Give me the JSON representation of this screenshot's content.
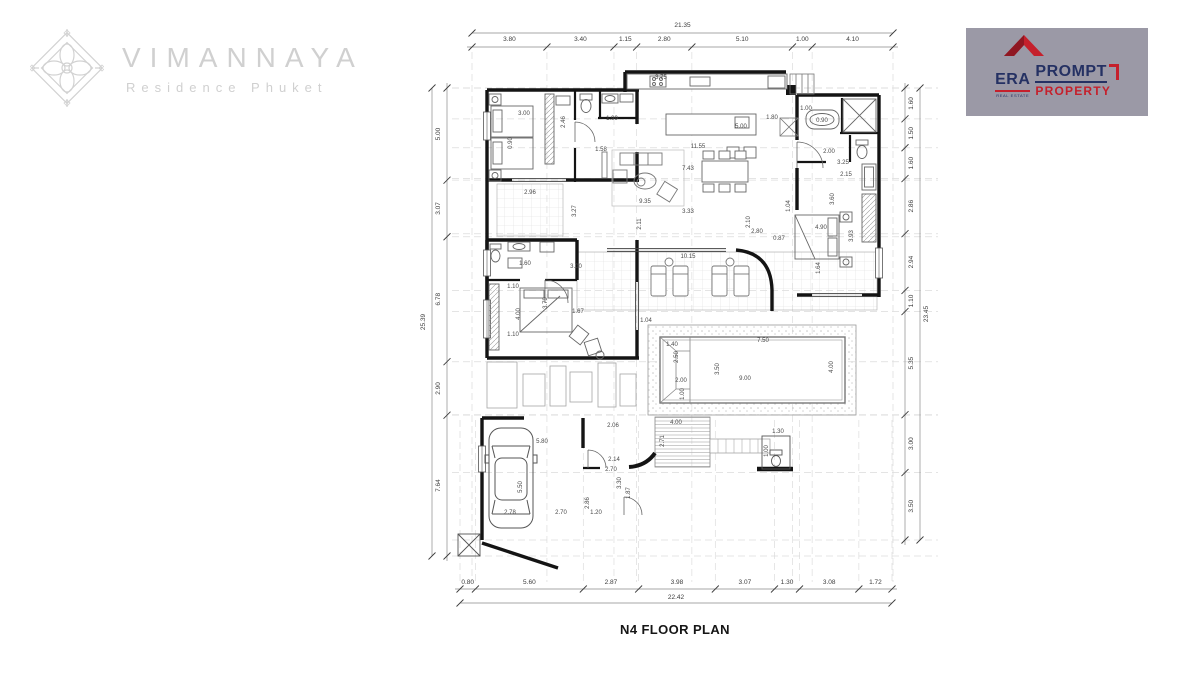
{
  "brand": {
    "name": "VIMANNAYA",
    "subtitle": "Residence Phuket"
  },
  "agency": {
    "era": "ERA",
    "real_estate": "REAL ESTATE",
    "prompt": "PROMPT",
    "property": "PROPERTY"
  },
  "plan_title": "N4 FLOOR PLAN",
  "icons": {
    "brand_ornament": "diamond-mandala",
    "agency_house": "red-roof-house"
  },
  "colors": {
    "brand_gray": "#d0d0d0",
    "agency_bg": "#9b99a6",
    "agency_red": "#c5202c",
    "agency_navy": "#253163",
    "wall": "#141414",
    "thin_line": "#6a6a6a",
    "dim_text": "#3c3c3c",
    "grid": "#dcdcdc"
  },
  "plan": {
    "dims": {
      "top": {
        "total": "21.35",
        "segments": [
          "3.80",
          "3.40",
          "1.15",
          "2.80",
          "5.10",
          "1.00",
          "4.10"
        ]
      },
      "bottom": {
        "total": "22.42",
        "segments": [
          "0.80",
          "5.60",
          "2.87",
          "3.98",
          "3.07",
          "1.30",
          "3.08",
          "1.72"
        ]
      },
      "left": {
        "total": "25.39",
        "segments": [
          "5.00",
          "3.07",
          "6.78",
          "2.90",
          "7.64"
        ]
      },
      "right": {
        "total": "23.45",
        "segments": [
          "1.60",
          "1.50",
          "1.60",
          "2.86",
          "2.94",
          "1.10",
          "5.35",
          "3.00",
          "3.50"
        ]
      }
    },
    "interior_dims": [
      {
        "t": "3.75",
        "x": 661,
        "y": 79,
        "r": 0
      },
      {
        "t": "5.00",
        "x": 741,
        "y": 128,
        "r": 0
      },
      {
        "t": "11.55",
        "x": 698,
        "y": 148,
        "r": 0
      },
      {
        "t": "1.99",
        "x": 612,
        "y": 120,
        "r": 0
      },
      {
        "t": "1.80",
        "x": 772,
        "y": 119,
        "r": 0
      },
      {
        "t": "1.00",
        "x": 806,
        "y": 110,
        "r": 0
      },
      {
        "t": "7.43",
        "x": 688,
        "y": 170,
        "r": 0
      },
      {
        "t": "1.58",
        "x": 601,
        "y": 151,
        "r": 0
      },
      {
        "t": "9.35",
        "x": 645,
        "y": 203,
        "r": 0
      },
      {
        "t": "3.33",
        "x": 688,
        "y": 213,
        "r": 0
      },
      {
        "t": "2.11",
        "x": 641,
        "y": 224,
        "r": 1
      },
      {
        "t": "2.80",
        "x": 757,
        "y": 233,
        "r": 0
      },
      {
        "t": "2.10",
        "x": 750,
        "y": 222,
        "r": 1
      },
      {
        "t": "0.90",
        "x": 822,
        "y": 122,
        "r": 0
      },
      {
        "t": "2.00",
        "x": 829,
        "y": 153,
        "r": 0
      },
      {
        "t": "2.15",
        "x": 846,
        "y": 176,
        "r": 0
      },
      {
        "t": "3.25",
        "x": 843,
        "y": 164,
        "r": 0
      },
      {
        "t": "1.04",
        "x": 790,
        "y": 206,
        "r": 1
      },
      {
        "t": "3.60",
        "x": 834,
        "y": 199,
        "r": 1
      },
      {
        "t": "4.90",
        "x": 821,
        "y": 229,
        "r": 0
      },
      {
        "t": "3.93",
        "x": 853,
        "y": 236,
        "r": 1
      },
      {
        "t": "0.87",
        "x": 779,
        "y": 240,
        "r": 0
      },
      {
        "t": "1.64",
        "x": 820,
        "y": 268,
        "r": 1
      },
      {
        "t": "10.15",
        "x": 688,
        "y": 258,
        "r": 0
      },
      {
        "t": "1.04",
        "x": 646,
        "y": 322,
        "r": 0
      },
      {
        "t": "7.50",
        "x": 763,
        "y": 342,
        "r": 0
      },
      {
        "t": "3.50",
        "x": 719,
        "y": 369,
        "r": 1
      },
      {
        "t": "9.00",
        "x": 745,
        "y": 380,
        "r": 0
      },
      {
        "t": "4.00",
        "x": 833,
        "y": 367,
        "r": 1
      },
      {
        "t": "2.50",
        "x": 678,
        "y": 357,
        "r": 1
      },
      {
        "t": "2.00",
        "x": 681,
        "y": 382,
        "r": 0
      },
      {
        "t": "1.00",
        "x": 684,
        "y": 394,
        "r": 1
      },
      {
        "t": "1.40",
        "x": 672,
        "y": 346,
        "r": 0
      },
      {
        "t": "2.96",
        "x": 530,
        "y": 194,
        "r": 0
      },
      {
        "t": "3.27",
        "x": 576,
        "y": 211,
        "r": 1
      },
      {
        "t": "3.00",
        "x": 524,
        "y": 115,
        "r": 0
      },
      {
        "t": "0.90",
        "x": 512,
        "y": 143,
        "r": 1
      },
      {
        "t": "2.46",
        "x": 565,
        "y": 122,
        "r": 1
      },
      {
        "t": "3.00",
        "x": 576,
        "y": 268,
        "r": 0
      },
      {
        "t": "1.60",
        "x": 525,
        "y": 265,
        "r": 0
      },
      {
        "t": "1.10",
        "x": 513,
        "y": 288,
        "r": 0
      },
      {
        "t": "4.00",
        "x": 520,
        "y": 314,
        "r": 1
      },
      {
        "t": "1.10",
        "x": 513,
        "y": 336,
        "r": 0
      },
      {
        "t": "3.79",
        "x": 547,
        "y": 303,
        "r": 1
      },
      {
        "t": "1.67",
        "x": 578,
        "y": 313,
        "r": 0
      },
      {
        "t": "4.00",
        "x": 676,
        "y": 424,
        "r": 0
      },
      {
        "t": "2.71",
        "x": 664,
        "y": 441,
        "r": 1
      },
      {
        "t": "1.30",
        "x": 778,
        "y": 433,
        "r": 0
      },
      {
        "t": "1.00",
        "x": 768,
        "y": 451,
        "r": 1
      },
      {
        "t": "5.80",
        "x": 542,
        "y": 443,
        "r": 0
      },
      {
        "t": "5.50",
        "x": 522,
        "y": 487,
        "r": 1
      },
      {
        "t": "2.78",
        "x": 510,
        "y": 514,
        "r": 0
      },
      {
        "t": "2.70",
        "x": 561,
        "y": 514,
        "r": 0
      },
      {
        "t": "2.06",
        "x": 613,
        "y": 427,
        "r": 0
      },
      {
        "t": "2.14",
        "x": 614,
        "y": 461,
        "r": 0
      },
      {
        "t": "2.70",
        "x": 611,
        "y": 471,
        "r": 0
      },
      {
        "t": "1.20",
        "x": 596,
        "y": 514,
        "r": 0
      },
      {
        "t": "2.86",
        "x": 589,
        "y": 503,
        "r": 1
      },
      {
        "t": "3.30",
        "x": 621,
        "y": 483,
        "r": 1
      },
      {
        "t": "1.87",
        "x": 630,
        "y": 493,
        "r": 1
      }
    ]
  }
}
